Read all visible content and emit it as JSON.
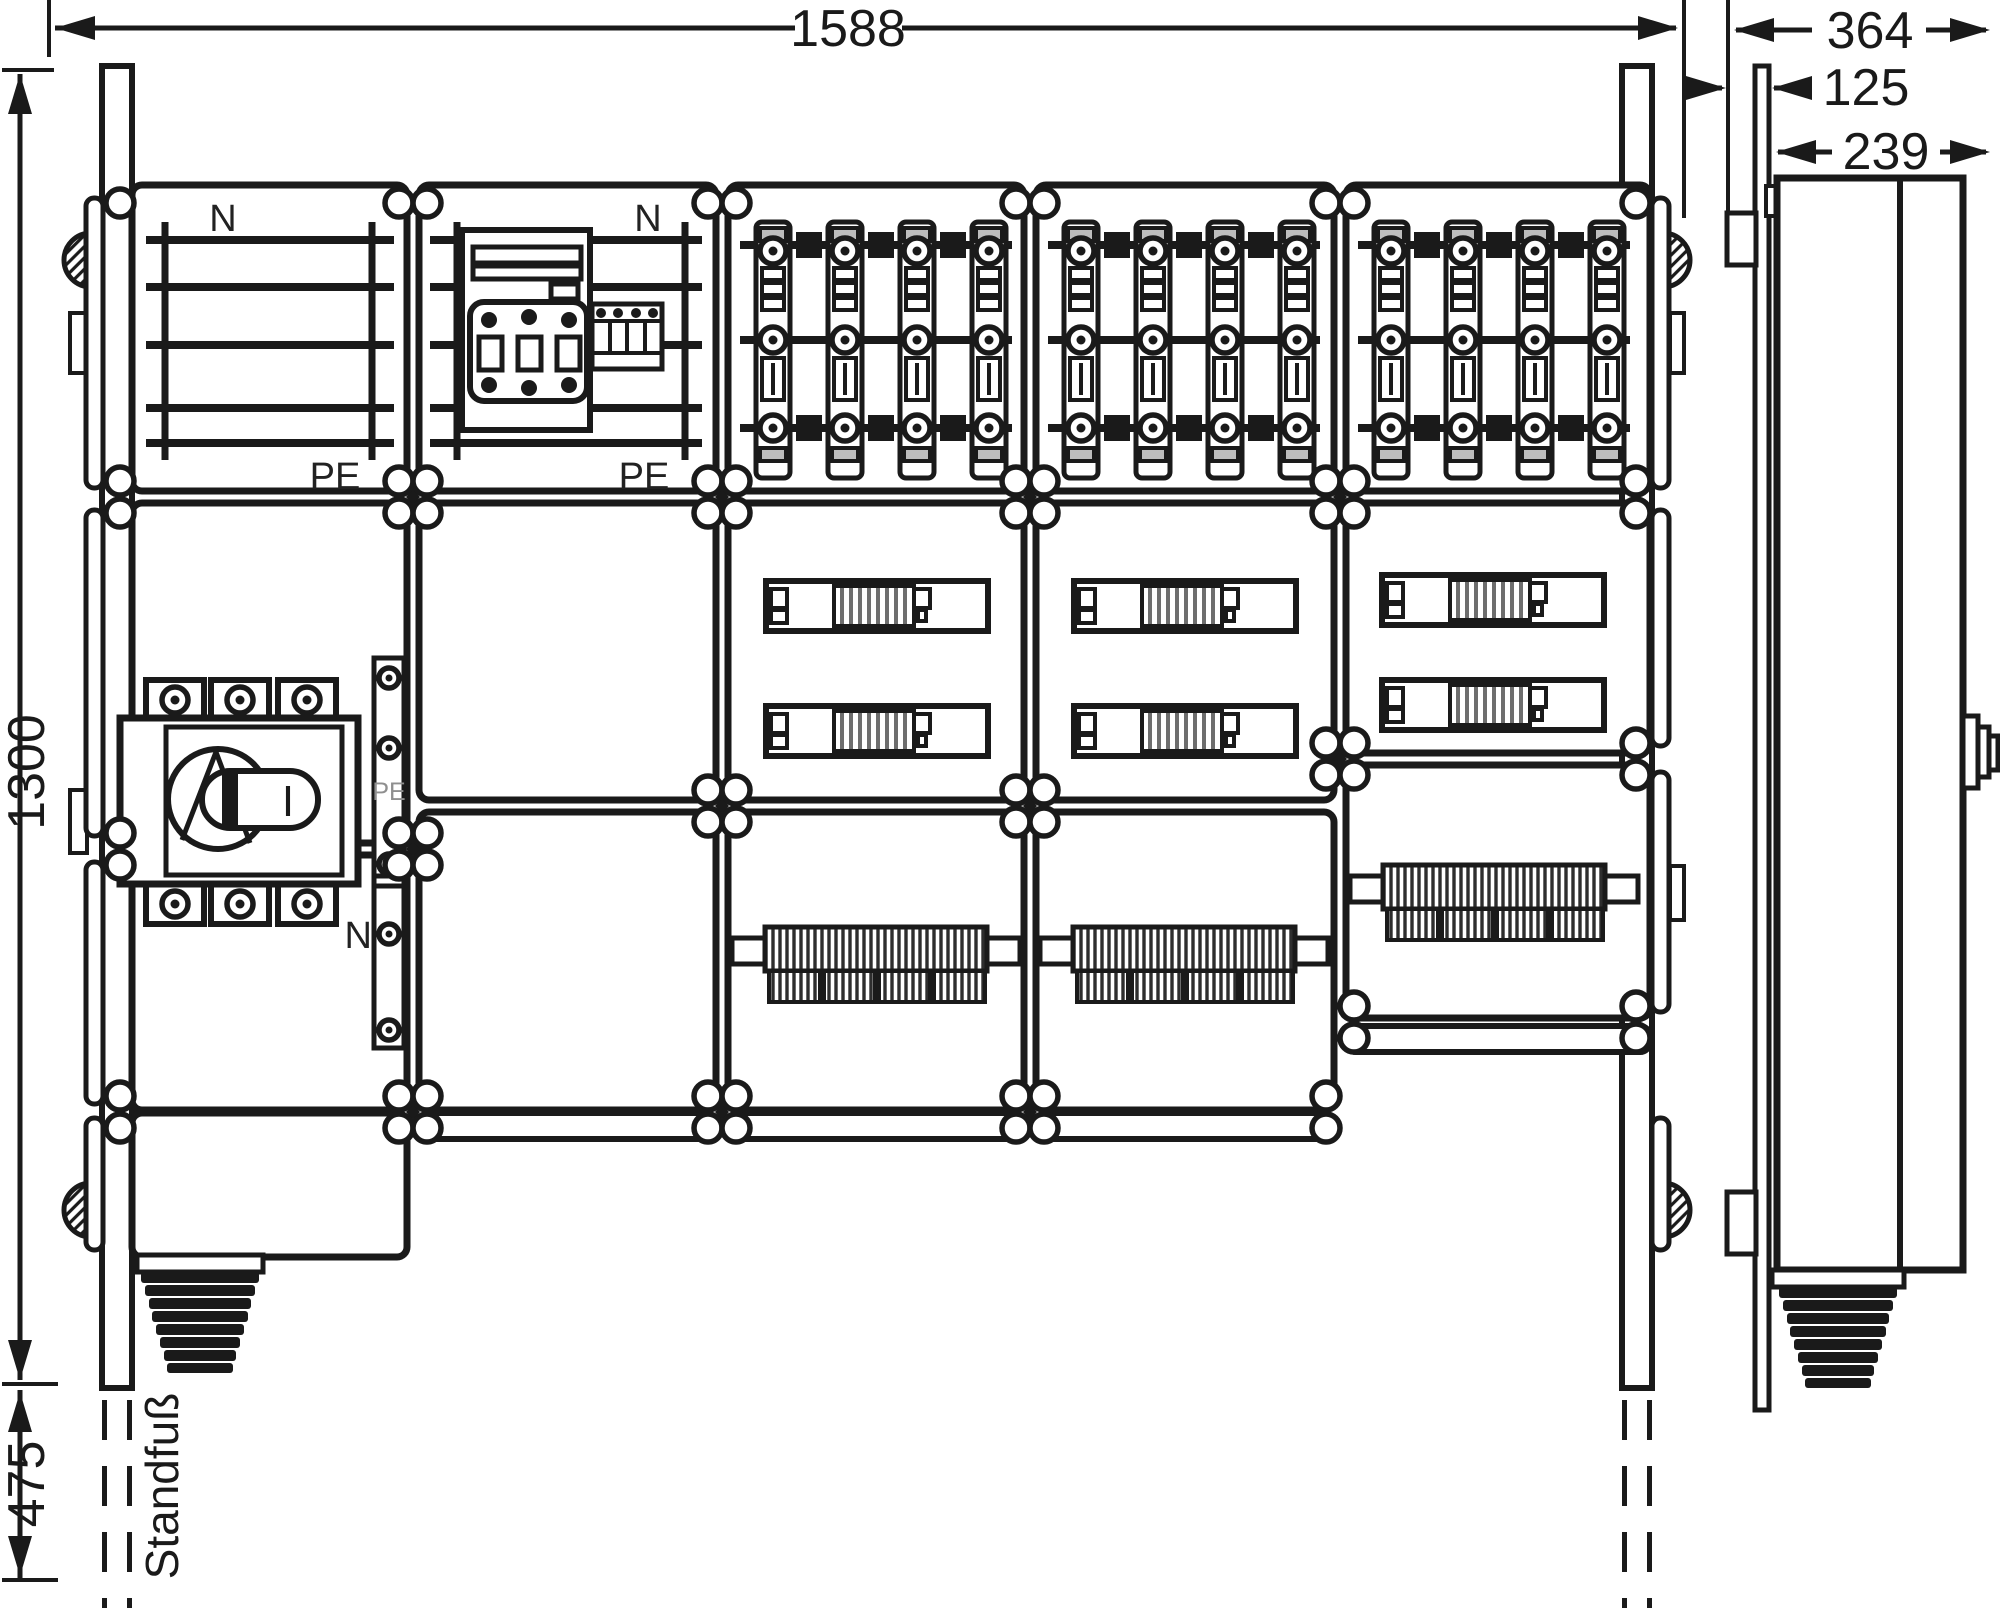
{
  "drawing": {
    "type": "dimensioned technical drawing of a floor-standing distribution cabinet",
    "views": [
      "front",
      "side"
    ],
    "background": "#ffffff",
    "line_color": "#1a1a1a"
  },
  "dimensions": {
    "overall_width": "1588",
    "enclosure_height": "1300",
    "stand_foot_height": "475",
    "side_total_depth": "364",
    "side_front_depth": "125",
    "side_body_depth": "239"
  },
  "labels": {
    "neutral": "N",
    "protective_earth": "PE",
    "stand_foot": "Standfuß",
    "switch_on": "I"
  }
}
